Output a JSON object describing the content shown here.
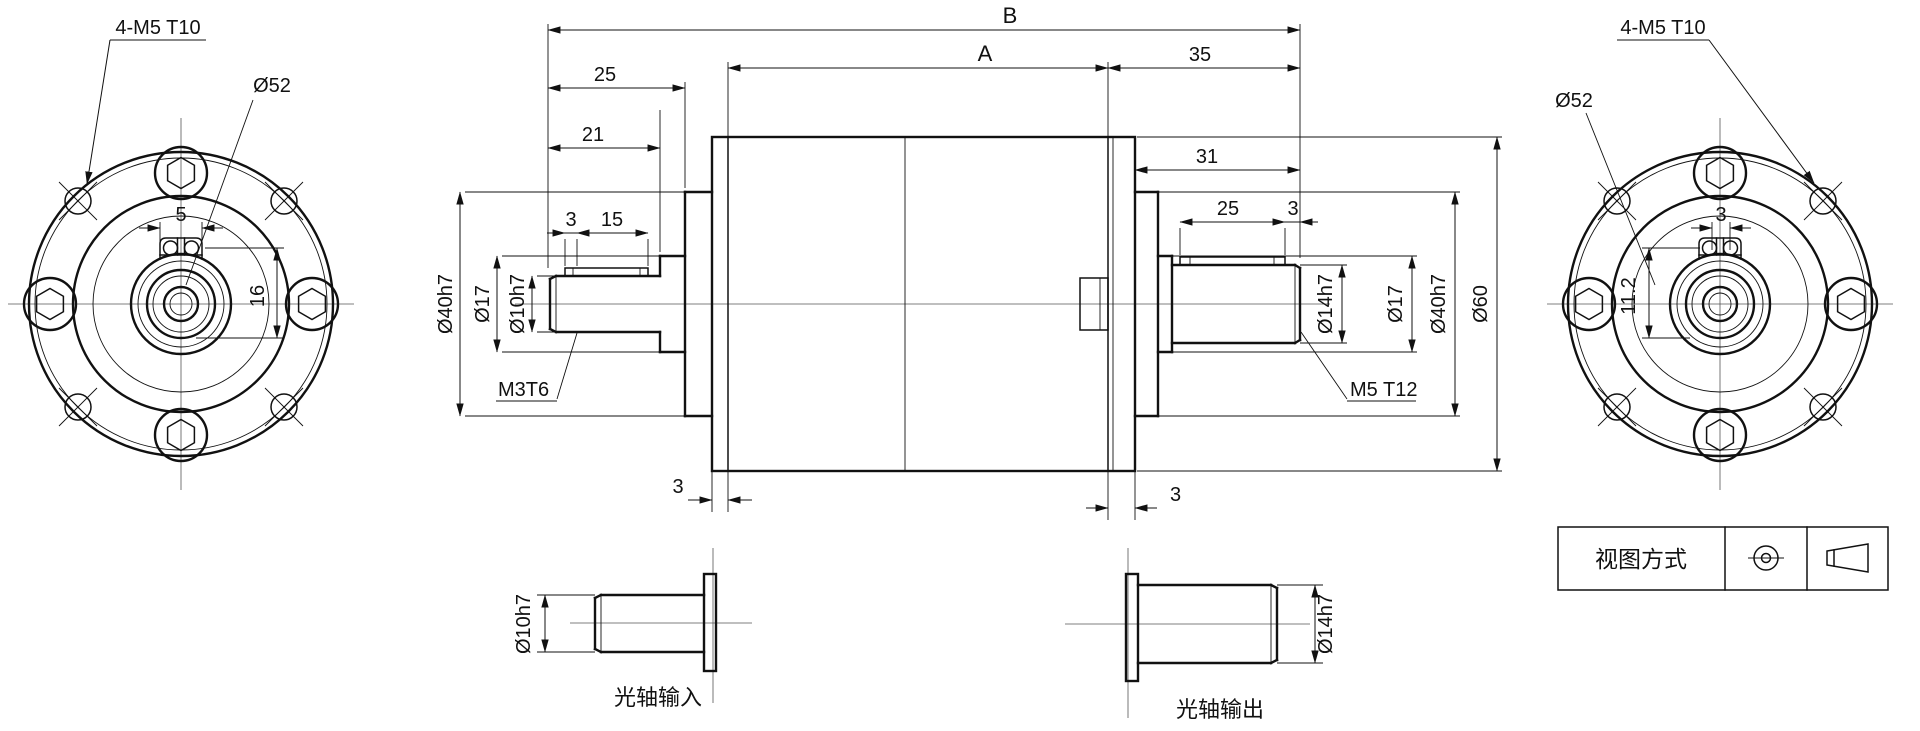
{
  "views": {
    "left_flange": {
      "thread_callout": "4-M5 T10",
      "bolt_circle": "Ø52",
      "clamp_width": "5",
      "bore_depth": "16"
    },
    "right_flange": {
      "thread_callout": "4-M5 T10",
      "bolt_circle": "Ø52",
      "clamp_width": "3",
      "bore_depth": "11.2"
    },
    "section": {
      "len_overall": "B",
      "len_body": "A",
      "len_front": "25",
      "len_rear": "35",
      "len_in_shaft": "21",
      "len_out_shaft": "31",
      "in_flat_setback": "3",
      "in_flat_len": "15",
      "out_flat_len": "25",
      "out_flat_setback": "3",
      "dia_in_pilot": "Ø40h7",
      "dia_in_boss": "Ø17",
      "dia_in_shaft": "Ø10h7",
      "thread_in": "M3T6",
      "dia_out_shaft": "Ø14h7",
      "dia_out_boss": "Ø17",
      "dia_out_pilot": "Ø40h7",
      "dia_body": "Ø60",
      "thread_out": "M5 T12",
      "front_plate_thk": "3",
      "rear_plate_thk": "3"
    },
    "input_detail": {
      "dia": "Ø10h7",
      "caption": "光轴输入"
    },
    "output_detail": {
      "dia": "Ø14h7",
      "caption": "光轴输出"
    },
    "projection_box": {
      "label": "视图方式"
    }
  }
}
